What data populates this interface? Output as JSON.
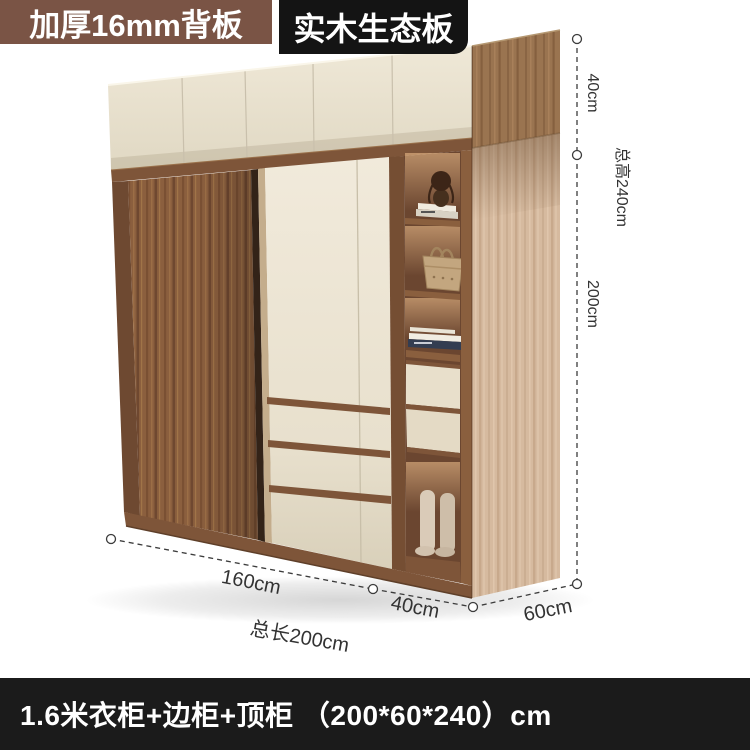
{
  "badges": {
    "back_panel": "加厚16mm背板",
    "eco_board": "实木生态板"
  },
  "annotations": {
    "top_cabinet_height": "40cm",
    "total_height": "总高240cm",
    "wardrobe_height": "200cm",
    "main_width": "160cm",
    "side_cabinet_width": "40cm",
    "total_length": "总长200cm",
    "depth": "60cm"
  },
  "footer": {
    "caption": "1.6米衣柜+边柜+顶柜 （200*60*240）cm"
  },
  "colors": {
    "badge_brown": "#7A5445",
    "badge_black": "#141414",
    "footer_bg": "#1B1B1B",
    "walnut_door": "#8B5F3E",
    "cream_door": "#EAE2D0",
    "light_oak_side": "#D6BA9F",
    "annotation_text": "#333333"
  },
  "decor_items": [
    "doll-figurine",
    "handbag",
    "stacked-books",
    "boots"
  ]
}
